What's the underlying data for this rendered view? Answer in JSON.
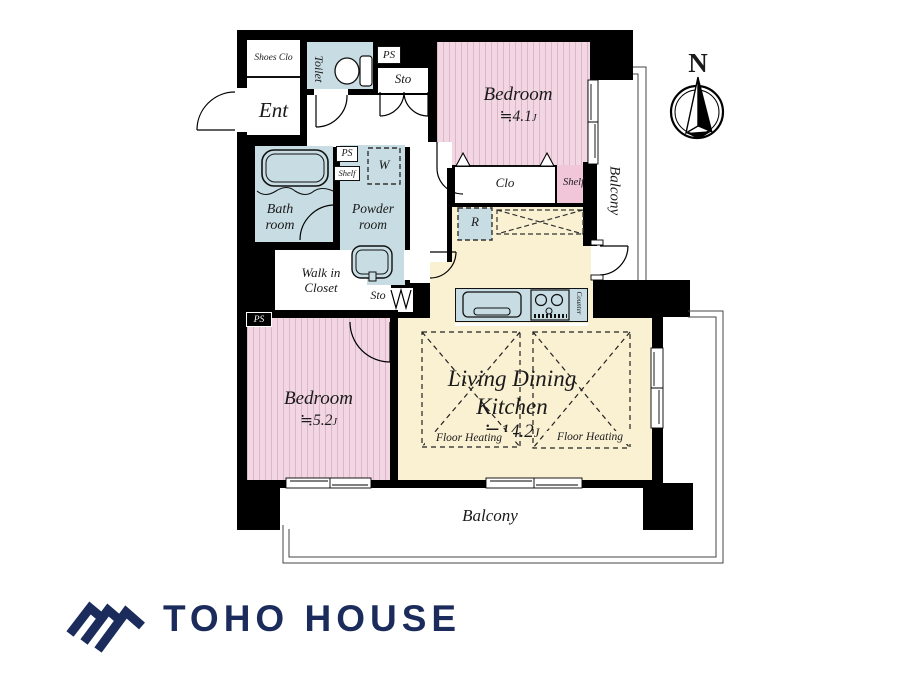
{
  "compass": {
    "north_label": "N"
  },
  "rooms": {
    "shoes_closet": {
      "label": "Shoes Clo"
    },
    "entrance": {
      "label": "Ent"
    },
    "toilet": {
      "label": "Toilet"
    },
    "pipe_space_top": {
      "label": "PS"
    },
    "storage_top": {
      "label": "Sto"
    },
    "bedroom_north": {
      "label": "Bedroom",
      "size": "≒4.1",
      "size_unit": "J"
    },
    "closet_north": {
      "label": "Clo"
    },
    "shelf_north": {
      "label": "Shelf"
    },
    "balcony_east": {
      "label": "Balcony"
    },
    "bathroom": {
      "label": "Bath room"
    },
    "pipe_space_mid": {
      "label": "PS"
    },
    "shelf_mid": {
      "label": "Shelf"
    },
    "washer": {
      "label": "W"
    },
    "powder_room": {
      "label": "Powder room"
    },
    "walk_in_closet": {
      "label": "Walk in Closet"
    },
    "storage_mid": {
      "label": "Sto"
    },
    "refrigerator": {
      "label": "R"
    },
    "counter": {
      "label": "Counter"
    },
    "living_dining_kitchen": {
      "name_line1": "Living Dining",
      "name_line2": "Kitchen",
      "size": "≒14.2",
      "size_unit": "J"
    },
    "floor_heating_left": {
      "label": "Floor Heating"
    },
    "floor_heating_right": {
      "label": "Floor Heating"
    },
    "bedroom_south": {
      "label": "Bedroom",
      "size": "≒5.2",
      "size_unit": "J"
    },
    "pipe_space_south": {
      "label": "PS"
    },
    "balcony_south": {
      "label": "Balcony"
    }
  },
  "branding": {
    "company_name": "TOHO HOUSE"
  },
  "colors": {
    "wall_black": "#000000",
    "room_pink": "#f2d7e2",
    "shelf_pink": "#f0c6d8",
    "room_blue": "#c8dde3",
    "room_beige": "#faf0d2",
    "brand_navy": "#1b2c5c"
  }
}
